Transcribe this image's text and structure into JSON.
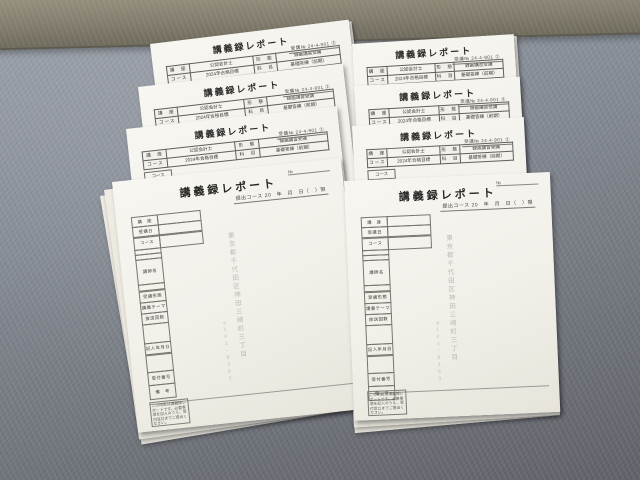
{
  "colors": {
    "carpet_light": "#9ba1ab",
    "carpet_dark": "#606369",
    "floor_strip": "#837d6e",
    "paper": "#f1efe8",
    "ink": "#2c2c2a",
    "table_line": "#5f5f5d"
  },
  "report": {
    "title": "講義録レポート",
    "no_label": "№",
    "header_note": "受講№ 24-4-901 ②",
    "header_left": "提出コース",
    "header_right": "20　年　月　日（　）限",
    "table_r1": [
      "講　座",
      "公認会計士",
      "形　態",
      "録画講習受講"
    ],
    "table_r2": [
      "コース",
      "2024年合格目標",
      "科　目",
      "基礎答練（前期）"
    ],
    "below_label": "コース",
    "fields": [
      "講　座",
      "受講日",
      "コース",
      "講師名",
      "受講形態",
      "講義テーマ",
      "放送回数",
      "記入年月日",
      "受付番号",
      "備　考"
    ],
    "watermark_main": "東京都千代田区神田三崎町三丁目",
    "watermark_sub": "〒101-8383",
    "fineprint": "この用紙は講義録レポートです。必要事項を記入のうえ、受付窓口までご提出ください。"
  }
}
